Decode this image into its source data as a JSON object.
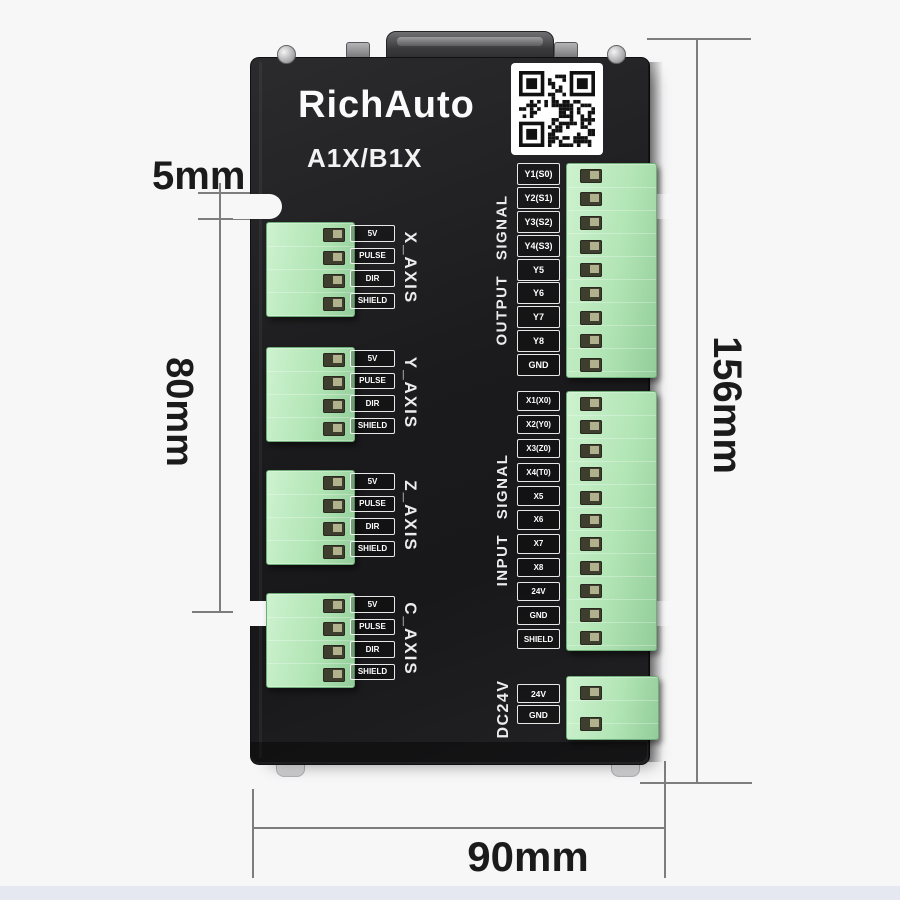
{
  "device": {
    "brand": "RichAuto",
    "model": "A1X/B1X"
  },
  "dimensions": {
    "top": "5mm",
    "left": "80mm",
    "right": "156mm",
    "bottom": "90mm"
  },
  "axis_groups": [
    {
      "name": "X_AXIS"
    },
    {
      "name": "Y_AXIS"
    },
    {
      "name": "Z_AXIS"
    },
    {
      "name": "C_AXIS"
    }
  ],
  "axis_pin_labels": [
    "5V",
    "PULSE",
    "DIR",
    "SHIELD"
  ],
  "output_signal": {
    "title": "OUTPUT SIGNAL",
    "labels": [
      "Y1(S0)",
      "Y2(S1)",
      "Y3(S2)",
      "Y4(S3)",
      "Y5",
      "Y6",
      "Y7",
      "Y8",
      "GND"
    ]
  },
  "input_signal": {
    "title": "INPUT SIGNAL",
    "labels": [
      "X1(X0)",
      "X2(Y0)",
      "X3(Z0)",
      "X4(T0)",
      "X5",
      "X6",
      "X7",
      "X8",
      "24V",
      "GND",
      "SHIELD"
    ]
  },
  "power": {
    "title": "DC24V",
    "labels": [
      "24V",
      "GND"
    ]
  },
  "icons": {
    "qr_code": "qr-code-icon"
  },
  "colors": {
    "board_black": "#1e1e20",
    "terminal_green": "#b2e5b5",
    "background": "#f7f7f8",
    "dimension_line": "#7d7d7d",
    "label_text": "#ffffff"
  }
}
